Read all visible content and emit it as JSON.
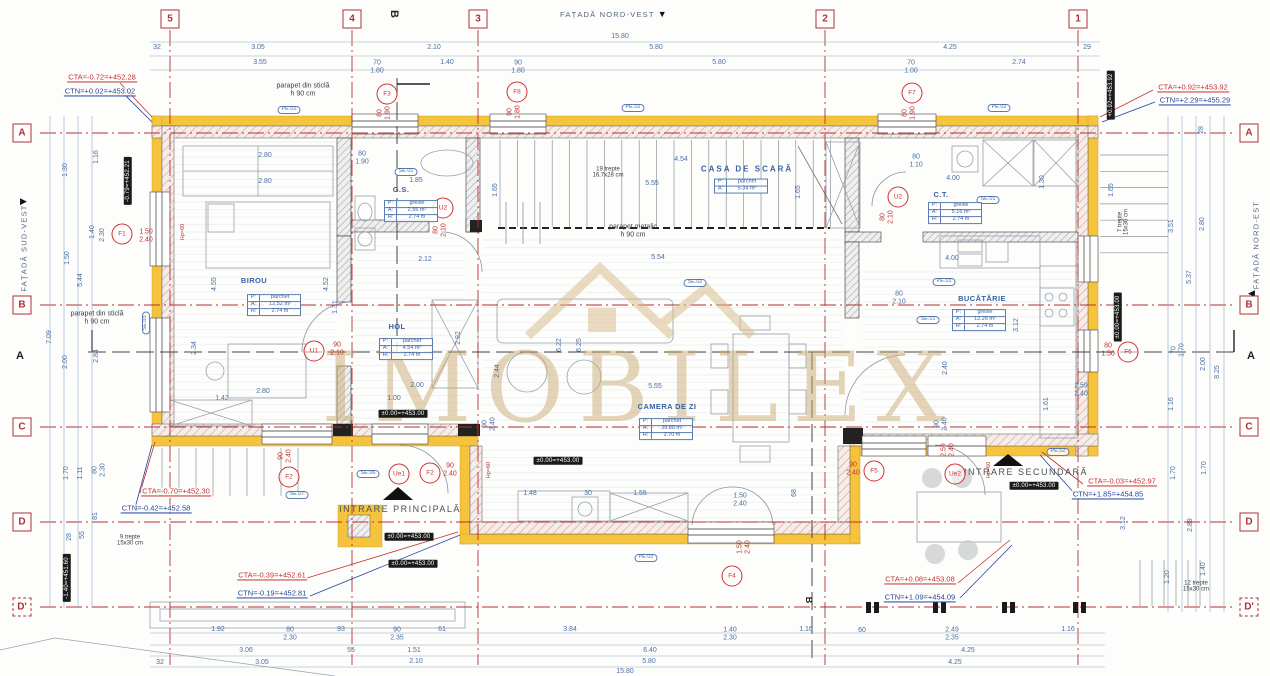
{
  "meta": {
    "drawing": "floor plan"
  },
  "watermark": {
    "text": "IMOBILEX"
  },
  "facades": {
    "top": "FAȚADĂ NORD-VEST",
    "left": "FAȚADĂ SUD-VEST",
    "right": "FAȚADĂ NORD-EST"
  },
  "sections": {
    "a": "A",
    "b": "B"
  },
  "grid": {
    "cols": [
      {
        "label": "5",
        "x": 170
      },
      {
        "label": "4",
        "x": 352
      },
      {
        "label": "3",
        "x": 478
      },
      {
        "label": "2",
        "x": 825
      },
      {
        "label": "1",
        "x": 1078
      }
    ],
    "rows": [
      {
        "label": "A",
        "y": 133
      },
      {
        "label": "B",
        "y": 305
      },
      {
        "label": "C",
        "y": 427
      },
      {
        "label": "D",
        "y": 522
      },
      {
        "label": "D'",
        "y": 607,
        "dashed": true
      }
    ]
  },
  "rooms": [
    {
      "name": "BIROU",
      "nx": 254,
      "ny": 281,
      "tx": 274,
      "ty": 305,
      "rows": [
        [
          "P:",
          "parchet"
        ],
        [
          "A:",
          "12.52 m²"
        ],
        [
          "H:",
          "2.74 m"
        ]
      ]
    },
    {
      "name": "HOL",
      "nx": 397,
      "ny": 327,
      "tx": 406,
      "ty": 349,
      "rows": [
        [
          "P:",
          "parchet"
        ],
        [
          "A:",
          "4.54 m²"
        ],
        [
          "H:",
          "2.74 m"
        ]
      ]
    },
    {
      "name": "G.S.",
      "nx": 401,
      "ny": 190,
      "tx": 411,
      "ty": 211,
      "rows": [
        [
          "P:",
          "gresie"
        ],
        [
          "A:",
          "2.56 m²"
        ],
        [
          "H:",
          "2.74 m"
        ]
      ]
    },
    {
      "name": "CASA DE SCARĂ",
      "big": true,
      "nx": 747,
      "ny": 170,
      "tx": 741,
      "ty": 186,
      "rows": [
        [
          "P:",
          "parchet"
        ],
        [
          "A:",
          "5.34 m²"
        ]
      ]
    },
    {
      "name": "CAMERA DE ZI",
      "nx": 667,
      "ny": 407,
      "tx": 666,
      "ty": 429,
      "rows": [
        [
          "P:",
          "parchet"
        ],
        [
          "A:",
          "39.80 m²"
        ],
        [
          "H:",
          "2.70 m"
        ]
      ]
    },
    {
      "name": "BUCĂTĂRIE",
      "nx": 982,
      "ny": 299,
      "tx": 979,
      "ty": 320,
      "rows": [
        [
          "P:",
          "gresie"
        ],
        [
          "A:",
          "12.26 m²"
        ],
        [
          "H:",
          "2.74 m"
        ]
      ]
    },
    {
      "name": "C.T.",
      "nx": 941,
      "ny": 195,
      "tx": 955,
      "ty": 213,
      "rows": [
        [
          "P:",
          "gresie"
        ],
        [
          "A:",
          "5.16 m²"
        ],
        [
          "H:",
          "2.74 m"
        ]
      ]
    }
  ],
  "entrances": [
    {
      "label": "INTRARE PRINCIPALĂ",
      "x": 400,
      "y": 509
    },
    {
      "label": "INTRARE SECUNDARĂ",
      "x": 1026,
      "y": 472
    }
  ],
  "levels": [
    {
      "t": "CTA=-0.72=+452.28",
      "x": 102,
      "y": 78,
      "k": "cta"
    },
    {
      "t": "CTN=+0.02=+453.02",
      "x": 100,
      "y": 92,
      "k": "ctn"
    },
    {
      "t": "CTA=+0.92=+453.92",
      "x": 1193,
      "y": 88,
      "k": "cta"
    },
    {
      "t": "CTN=+2.29=+455.29",
      "x": 1195,
      "y": 101,
      "k": "ctn"
    },
    {
      "t": "CTA=-0.70=+452.30",
      "x": 176,
      "y": 492,
      "k": "cta"
    },
    {
      "t": "CTN=-0.42=+452.58",
      "x": 156,
      "y": 509,
      "k": "ctn"
    },
    {
      "t": "CTA=-0.39=+452.61",
      "x": 272,
      "y": 576,
      "k": "cta"
    },
    {
      "t": "CTN=-0.19=+452.81",
      "x": 272,
      "y": 594,
      "k": "ctn"
    },
    {
      "t": "CTA=+0.08=+453.08",
      "x": 920,
      "y": 580,
      "k": "cta"
    },
    {
      "t": "CTN=+1.09=+454.09",
      "x": 920,
      "y": 598,
      "k": "ctn"
    },
    {
      "t": "CTA=-0.03=+452.97",
      "x": 1122,
      "y": 482,
      "k": "cta"
    },
    {
      "t": "CTN=+1.85=+454.85",
      "x": 1108,
      "y": 495,
      "k": "ctn"
    }
  ],
  "level_boxes": [
    {
      "t": "±0.00=+453.00",
      "x": 403,
      "y": 414
    },
    {
      "t": "±0.00=+453.00",
      "x": 558,
      "y": 461
    },
    {
      "t": "±0.00=+453.00",
      "x": 409,
      "y": 537
    },
    {
      "t": "±0.00=+453.00",
      "x": 413,
      "y": 564
    },
    {
      "t": "±0.00=+453.00",
      "x": 1034,
      "y": 486
    },
    {
      "t": "-0.79=+452.21",
      "x": 128,
      "y": 181,
      "r": -90
    },
    {
      "t": "-1.40=+451.60",
      "x": 67,
      "y": 578,
      "r": -90
    },
    {
      "t": "+0.92=+453.92",
      "x": 1111,
      "y": 95,
      "r": -90
    },
    {
      "t": "±0.00=+453.00",
      "x": 1118,
      "y": 317,
      "r": -90
    }
  ],
  "openings": [
    {
      "l": "F1",
      "x": 122,
      "y": 234,
      "sz": "1.50|2.40",
      "sx": 146,
      "sy": 236,
      "sr": 0
    },
    {
      "l": "F2",
      "x": 289,
      "y": 477,
      "sz": "90|2.40",
      "sx": 285,
      "sy": 456,
      "sr": -90
    },
    {
      "l": "F3",
      "x": 387,
      "y": 94,
      "sz": "80|1.90",
      "sx": 384,
      "sy": 113,
      "sr": -90
    },
    {
      "l": "F8",
      "x": 517,
      "y": 92,
      "sz": "90|1.80",
      "sx": 514,
      "sy": 112,
      "sr": -90
    },
    {
      "l": "F7",
      "x": 912,
      "y": 93,
      "sz": "80|1.90",
      "sx": 909,
      "sy": 113,
      "sr": -90
    },
    {
      "l": "F6",
      "x": 1128,
      "y": 352,
      "sz": "80|1.50",
      "sx": 1108,
      "sy": 350,
      "sr": 0
    },
    {
      "l": "F5",
      "x": 874,
      "y": 471,
      "sz": "90|2.40",
      "sx": 853,
      "sy": 469,
      "sr": 0
    },
    {
      "l": "F4",
      "x": 732,
      "y": 576,
      "sz": "1.50|2.40",
      "sx": 744,
      "sy": 547,
      "sr": -90
    },
    {
      "l": "U1",
      "x": 314,
      "y": 351,
      "sz": "90|2.10",
      "sx": 337,
      "sy": 349,
      "sr": 0
    },
    {
      "l": "U2",
      "x": 443,
      "y": 208,
      "sz": "80|2.10",
      "sx": 440,
      "sy": 230,
      "sr": -90
    },
    {
      "l": "U2",
      "x": 898,
      "y": 197,
      "sz": "80|2.10",
      "sx": 887,
      "sy": 217,
      "sr": -90
    },
    {
      "l": "Ue1",
      "x": 399,
      "y": 474,
      "sz": "",
      "sx": 0,
      "sy": 0,
      "sr": 0
    },
    {
      "l": "F2",
      "x": 430,
      "y": 473,
      "sz": "90|2.40",
      "sx": 450,
      "sy": 470,
      "sr": 0
    },
    {
      "l": "Ue2",
      "x": 955,
      "y": 474,
      "sz": "2.59|2.40",
      "sx": 948,
      "sy": 450,
      "sr": -90
    }
  ],
  "tags": [
    {
      "t": "PE.01",
      "x": 289,
      "y": 110
    },
    {
      "t": "PE.02",
      "x": 633,
      "y": 108
    },
    {
      "t": "PE.02",
      "x": 999,
      "y": 108
    },
    {
      "t": "SE.01",
      "x": 406,
      "y": 172
    },
    {
      "t": "PE.03",
      "x": 944,
      "y": 282
    },
    {
      "t": "SE.01",
      "x": 988,
      "y": 200
    },
    {
      "t": "SE.02",
      "x": 695,
      "y": 283
    },
    {
      "t": "SE.01",
      "x": 928,
      "y": 320
    },
    {
      "t": "PE.02",
      "x": 646,
      "y": 558
    },
    {
      "t": "SE.06",
      "x": 368,
      "y": 474
    },
    {
      "t": "SE.07",
      "x": 297,
      "y": 495
    },
    {
      "t": "PE.02",
      "x": 1058,
      "y": 452
    },
    {
      "t": "SE.03",
      "x": 146,
      "y": 323,
      "r": -90
    }
  ],
  "notes": [
    {
      "t": "parapet din sticlă|h 90 cm",
      "x": 303,
      "y": 90
    },
    {
      "t": "parapet din sticlă|h 90 cm",
      "x": 97,
      "y": 318
    },
    {
      "t": "parapet metalic|h 90 cm",
      "x": 633,
      "y": 231
    },
    {
      "t": "19 trepte|16,7x28 cm",
      "x": 608,
      "y": 173,
      "small": true
    },
    {
      "t": "9 trepte|15x30 cm",
      "x": 130,
      "y": 541,
      "small": true
    },
    {
      "t": "7 trepte|15x30 cm",
      "x": 1124,
      "y": 222,
      "r": -90,
      "small": true
    },
    {
      "t": "12 trepte|15x30 cm",
      "x": 1196,
      "y": 587,
      "small": true
    }
  ],
  "hp_marks": [
    {
      "t": "Hp=60",
      "x": 184,
      "y": 232
    },
    {
      "t": "Hp=60",
      "x": 490,
      "y": 470
    },
    {
      "t": "Hp=60",
      "x": 990,
      "y": 470
    }
  ],
  "dims": [
    {
      "t": "15.80",
      "x": 620,
      "y": 37
    },
    {
      "t": "32",
      "x": 157,
      "y": 48
    },
    {
      "t": "3.05",
      "x": 258,
      "y": 48
    },
    {
      "t": "2.10",
      "x": 434,
      "y": 48
    },
    {
      "t": "5.80",
      "x": 656,
      "y": 48
    },
    {
      "t": "4.25",
      "x": 950,
      "y": 48
    },
    {
      "t": "29",
      "x": 1087,
      "y": 48
    },
    {
      "t": "3.55",
      "x": 260,
      "y": 63
    },
    {
      "t": "70|1.80",
      "x": 377,
      "y": 67
    },
    {
      "t": "1.40",
      "x": 447,
      "y": 63
    },
    {
      "t": "90|1.80",
      "x": 518,
      "y": 67
    },
    {
      "t": "5.80",
      "x": 719,
      "y": 63
    },
    {
      "t": "70|1.00",
      "x": 911,
      "y": 67
    },
    {
      "t": "2.74",
      "x": 1019,
      "y": 63
    },
    {
      "t": "1.92",
      "x": 218,
      "y": 630
    },
    {
      "t": "80|2.30",
      "x": 290,
      "y": 634
    },
    {
      "t": "93",
      "x": 341,
      "y": 630
    },
    {
      "t": "90|2.35",
      "x": 397,
      "y": 634
    },
    {
      "t": "61",
      "x": 442,
      "y": 630
    },
    {
      "t": "3.84",
      "x": 570,
      "y": 630
    },
    {
      "t": "1.40|2.30",
      "x": 730,
      "y": 634
    },
    {
      "t": "1.16",
      "x": 806,
      "y": 630
    },
    {
      "t": "60",
      "x": 862,
      "y": 631
    },
    {
      "t": "2.49|2.35",
      "x": 952,
      "y": 634
    },
    {
      "t": "1.16",
      "x": 1068,
      "y": 630
    },
    {
      "t": "3.06",
      "x": 246,
      "y": 651
    },
    {
      "t": "55",
      "x": 351,
      "y": 651
    },
    {
      "t": "1.51",
      "x": 414,
      "y": 651
    },
    {
      "t": "6.40",
      "x": 650,
      "y": 651
    },
    {
      "t": "4.25",
      "x": 968,
      "y": 651
    },
    {
      "t": "32",
      "x": 160,
      "y": 663
    },
    {
      "t": "3.05",
      "x": 262,
      "y": 663
    },
    {
      "t": "2.10",
      "x": 416,
      "y": 662
    },
    {
      "t": "5.80",
      "x": 649,
      "y": 662
    },
    {
      "t": "4.25",
      "x": 955,
      "y": 663
    },
    {
      "t": "15.80",
      "x": 625,
      "y": 672
    },
    {
      "t": "1.16",
      "x": 97,
      "y": 157,
      "r": -90
    },
    {
      "t": "1.30",
      "x": 66,
      "y": 170,
      "r": -90
    },
    {
      "t": "1.40",
      "x": 93,
      "y": 232,
      "r": -90
    },
    {
      "t": "2.30",
      "x": 103,
      "y": 235,
      "r": -90
    },
    {
      "t": "1.50",
      "x": 68,
      "y": 258,
      "r": -90
    },
    {
      "t": "5.44",
      "x": 81,
      "y": 280,
      "r": -90
    },
    {
      "t": "7.09",
      "x": 50,
      "y": 337,
      "r": -90
    },
    {
      "t": "2.00",
      "x": 66,
      "y": 362,
      "r": -90
    },
    {
      "t": "2.84",
      "x": 97,
      "y": 356,
      "r": -90
    },
    {
      "t": "1.70",
      "x": 67,
      "y": 473,
      "r": -90
    },
    {
      "t": "1.11",
      "x": 81,
      "y": 473,
      "r": -90
    },
    {
      "t": "80|2.30",
      "x": 99,
      "y": 470,
      "r": -90
    },
    {
      "t": "28",
      "x": 70,
      "y": 537,
      "r": -90
    },
    {
      "t": "55",
      "x": 83,
      "y": 535,
      "r": -90
    },
    {
      "t": "81",
      "x": 96,
      "y": 516,
      "r": -90
    },
    {
      "t": "28",
      "x": 1202,
      "y": 130,
      "r": -90
    },
    {
      "t": "3.51",
      "x": 1172,
      "y": 226,
      "r": -90
    },
    {
      "t": "2.80",
      "x": 1203,
      "y": 224,
      "r": -90
    },
    {
      "t": "5.37",
      "x": 1190,
      "y": 277,
      "r": -90
    },
    {
      "t": "70|1.70",
      "x": 1178,
      "y": 350,
      "r": -90
    },
    {
      "t": "2.00",
      "x": 1204,
      "y": 364,
      "r": -90
    },
    {
      "t": "8.25",
      "x": 1218,
      "y": 372,
      "r": -90
    },
    {
      "t": "1.16",
      "x": 1172,
      "y": 404,
      "r": -90
    },
    {
      "t": "1.70",
      "x": 1174,
      "y": 473,
      "r": -90
    },
    {
      "t": "1.70",
      "x": 1205,
      "y": 468,
      "r": -90
    },
    {
      "t": "3.12",
      "x": 1124,
      "y": 523,
      "r": -90
    },
    {
      "t": "2.89",
      "x": 1191,
      "y": 525,
      "r": -90
    },
    {
      "t": "1.20",
      "x": 1168,
      "y": 577,
      "r": -90
    },
    {
      "t": "1.40",
      "x": 1204,
      "y": 569,
      "r": -90
    },
    {
      "t": "2.80",
      "x": 265,
      "y": 156
    },
    {
      "t": "2.80",
      "x": 265,
      "y": 182
    },
    {
      "t": "2.80",
      "x": 263,
      "y": 392
    },
    {
      "t": "1.42",
      "x": 222,
      "y": 399
    },
    {
      "t": "2.34",
      "x": 195,
      "y": 348,
      "r": -90
    },
    {
      "t": "4.55",
      "x": 215,
      "y": 284,
      "r": -90
    },
    {
      "t": "4.52",
      "x": 327,
      "y": 284,
      "r": -90
    },
    {
      "t": "1.31",
      "x": 336,
      "y": 307,
      "r": -90
    },
    {
      "t": "80|1.90",
      "x": 362,
      "y": 158
    },
    {
      "t": "1.85",
      "x": 416,
      "y": 181
    },
    {
      "t": "2.12",
      "x": 425,
      "y": 260
    },
    {
      "t": "1.65",
      "x": 496,
      "y": 190,
      "r": -90
    },
    {
      "t": "2.92",
      "x": 459,
      "y": 338,
      "r": -90
    },
    {
      "t": "2.00",
      "x": 417,
      "y": 386
    },
    {
      "t": "1.00",
      "x": 394,
      "y": 399
    },
    {
      "t": "4.54",
      "x": 681,
      "y": 160
    },
    {
      "t": "5.55",
      "x": 652,
      "y": 184
    },
    {
      "t": "5.54",
      "x": 658,
      "y": 258
    },
    {
      "t": "1.65",
      "x": 799,
      "y": 192,
      "r": -90
    },
    {
      "t": "6.22",
      "x": 560,
      "y": 345,
      "r": -90
    },
    {
      "t": "6.25",
      "x": 580,
      "y": 345,
      "r": -90
    },
    {
      "t": "5.55",
      "x": 655,
      "y": 387
    },
    {
      "t": "2.44",
      "x": 498,
      "y": 371,
      "r": -90
    },
    {
      "t": "2.40",
      "x": 946,
      "y": 368,
      "r": -90
    },
    {
      "t": "90|2.40",
      "x": 489,
      "y": 424,
      "r": -90
    },
    {
      "t": "90|2.40",
      "x": 941,
      "y": 424,
      "r": -90
    },
    {
      "t": "1.48",
      "x": 530,
      "y": 494
    },
    {
      "t": "30",
      "x": 588,
      "y": 494
    },
    {
      "t": "1.55",
      "x": 640,
      "y": 494
    },
    {
      "t": "1.50|2.40",
      "x": 740,
      "y": 500
    },
    {
      "t": "68",
      "x": 795,
      "y": 493,
      "r": -90
    },
    {
      "t": "80|1.10",
      "x": 916,
      "y": 161
    },
    {
      "t": "4.00",
      "x": 953,
      "y": 179
    },
    {
      "t": "1.30",
      "x": 1043,
      "y": 182,
      "r": -90
    },
    {
      "t": "4.00",
      "x": 952,
      "y": 259
    },
    {
      "t": "80|2.10",
      "x": 899,
      "y": 298
    },
    {
      "t": "2.59|2.40",
      "x": 1081,
      "y": 390
    },
    {
      "t": "3.12",
      "x": 1017,
      "y": 325,
      "r": -90
    },
    {
      "t": "1.61",
      "x": 1047,
      "y": 404,
      "r": -90
    },
    {
      "t": "1.65",
      "x": 1112,
      "y": 190,
      "r": -90
    }
  ]
}
